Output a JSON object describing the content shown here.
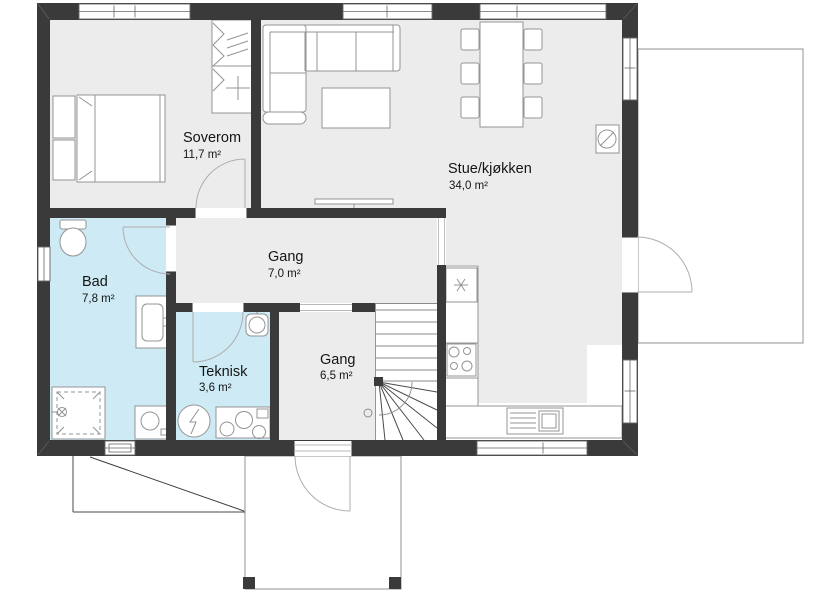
{
  "plan_type": "house-floor-plan",
  "rooms": [
    {
      "name": "Soverom",
      "area": "11,7 m²"
    },
    {
      "name": "Stue/kjøkken",
      "area": "34,0 m²"
    },
    {
      "name": "Gang",
      "area": "7,0 m²"
    },
    {
      "name": "Bad",
      "area": "7,8 m²"
    },
    {
      "name": "Teknisk",
      "area": "3,6 m²"
    },
    {
      "name": "Gang",
      "area": "6,5 m²"
    }
  ],
  "colors": {
    "wall": "#3a3a3a",
    "floor_dry": "#ececec",
    "floor_wet": "#cdeaf5",
    "furniture_line": "#949494",
    "background": "#ffffff"
  }
}
